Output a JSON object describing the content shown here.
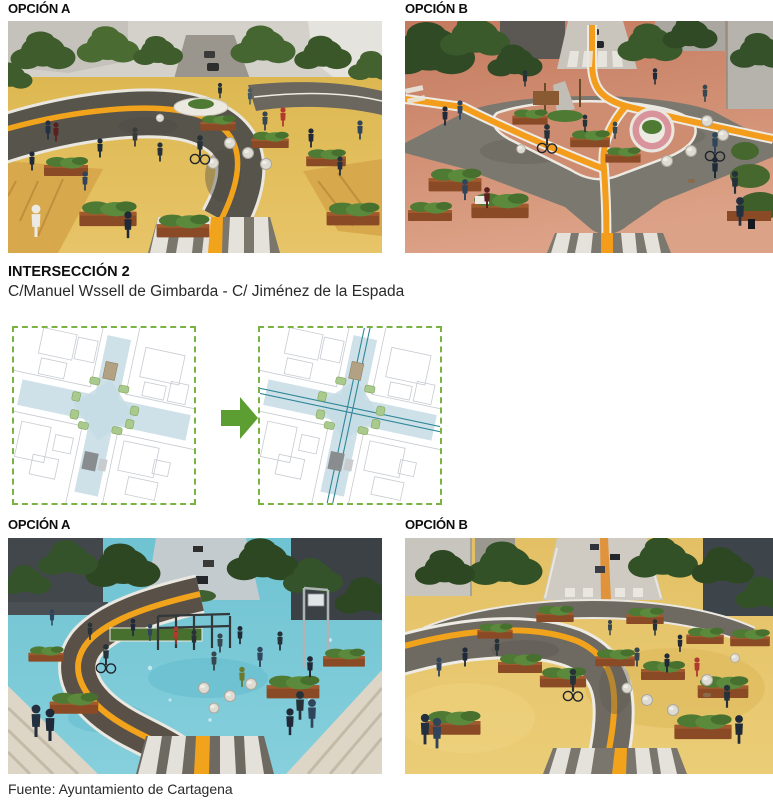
{
  "page": {
    "background": "#ffffff"
  },
  "panels": [
    {
      "id": "top-option-a",
      "label": "OPCIÓN A",
      "alt": "render-yellow-plaza-intersection",
      "ground_color": "#E2BD58",
      "road_color": "#57544C",
      "bike_lane_color": "#F2A31C"
    },
    {
      "id": "top-option-b",
      "label": "OPCIÓN B",
      "alt": "render-salmon-plaza-intersection",
      "ground_color": "#CF8166",
      "road_color": "#7B786F",
      "bike_lane_color": "#F49C1C"
    },
    {
      "id": "bottom-option-a",
      "label": "OPCIÓN A",
      "alt": "render-cyan-plaza-playground",
      "ground_color": "#7AC9D7",
      "road_color": "#595148",
      "bike_lane_color": "#F2A31C"
    },
    {
      "id": "bottom-option-b",
      "label": "OPCIÓN B",
      "alt": "render-sand-plaza-intersection",
      "ground_color": "#E8C86D",
      "road_color": "#6E6961",
      "bike_lane_color": "#F2A31C"
    }
  ],
  "section": {
    "title": "INTERSECCIÓN 2",
    "subtitle": "C/Manuel Wssell de Gimbarda - C/ Jiménez de la Espada"
  },
  "diagrams": {
    "before": {
      "name": "existing-intersection-plan",
      "border_color": "#79B344",
      "highlight_color": "#C5DCE4"
    },
    "after": {
      "name": "proposed-intersection-plan",
      "border_color": "#79B344",
      "highlight_color": "#C5DCE4",
      "bike_line_color": "#2F8799"
    },
    "arrow_color": "#5C9E31"
  },
  "footer": {
    "source": "Fuente: Ayuntamiento de Cartagena"
  }
}
